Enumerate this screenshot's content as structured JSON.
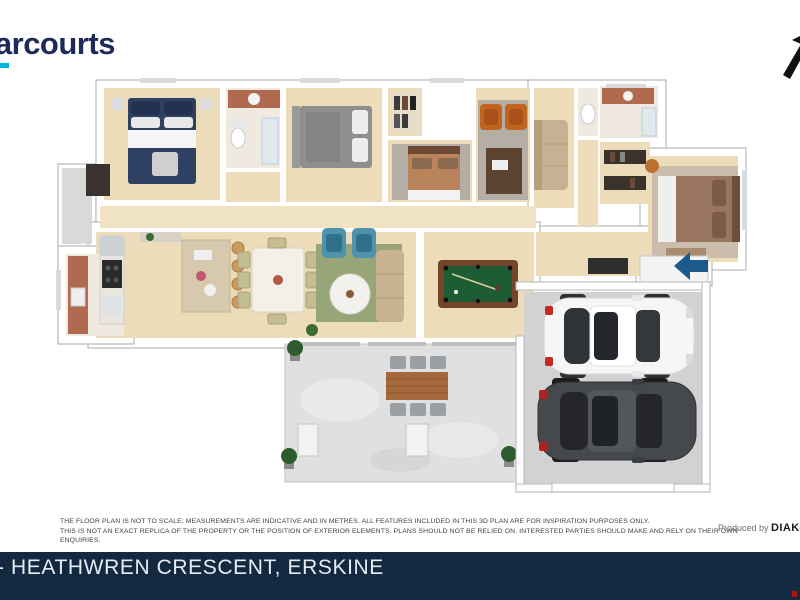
{
  "header": {
    "brand": "Harcourts",
    "brand_color": "#1e2a5a",
    "accent_color": "#00b5e2"
  },
  "north_arrow": {
    "color": "#111111"
  },
  "plan": {
    "palette": {
      "wall": "#ffffff",
      "wall_edge": "#b8b8b8",
      "wood_floor": "#ecdcba",
      "hall_floor": "#f0e3c4",
      "concrete": "#e0e0e0",
      "garage_floor": "#d2d2d2",
      "pool_table_felt": "#1e5c33",
      "entry_arrow": "#1d5a8c",
      "rug_green": "#98a579",
      "rug_gray": "#b5aea6",
      "bed_navy": "#2f4163",
      "bed_gray": "#8f8f8f",
      "bed_tan": "#b9845c",
      "bed_brown": "#99755f",
      "armchair_teal": "#4d93aa",
      "chair_orange": "#c0641f",
      "vanity_brick": "#b06a50",
      "car_white": "#f6f6f6",
      "car_dark": "#45484d"
    }
  },
  "disclaimer": {
    "line1": "THE FLOOR PLAN IS NOT TO SCALE; MEASUREMENTS ARE INDICATIVE AND IN METRES. ALL FEATURES INCLUDED IN THIS 3D PLAN ARE FOR INSPIRATION PURPOSES ONLY.",
    "line2": "THIS IS NOT AN EXACT REPLICA OF THE PROPERTY OR THE POSITION OF EXTERIOR ELEMENTS. PLANS SHOULD NOT BE RELIED ON. INTERESTED PARTIES SHOULD MAKE AND RELY ON THEIR OWN ENQUIRIES."
  },
  "credit": {
    "prefix": "Produced by ",
    "brand": "DIAK"
  },
  "footer": {
    "bar_color": "#132940",
    "address_fragment": "-",
    "address": "HEATHWREN CRESCENT, ERSKINE"
  }
}
